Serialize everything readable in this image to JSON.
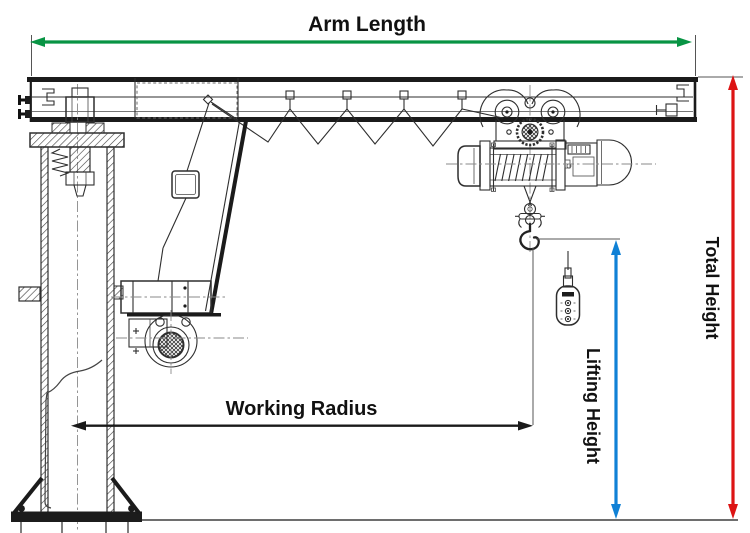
{
  "annotations": {
    "arm_length": {
      "label": "Arm Length",
      "color": "#089444"
    },
    "total_height": {
      "label": "Total Height",
      "color": "#dd1414"
    },
    "lifting_height": {
      "label": "Lifting Height",
      "color": "#1081d6"
    },
    "working_radius": {
      "label": "Working Radius",
      "color": "#1a1a1a"
    }
  },
  "drawing": {
    "line_color": "#2e2e2e",
    "background": "#ffffff"
  }
}
